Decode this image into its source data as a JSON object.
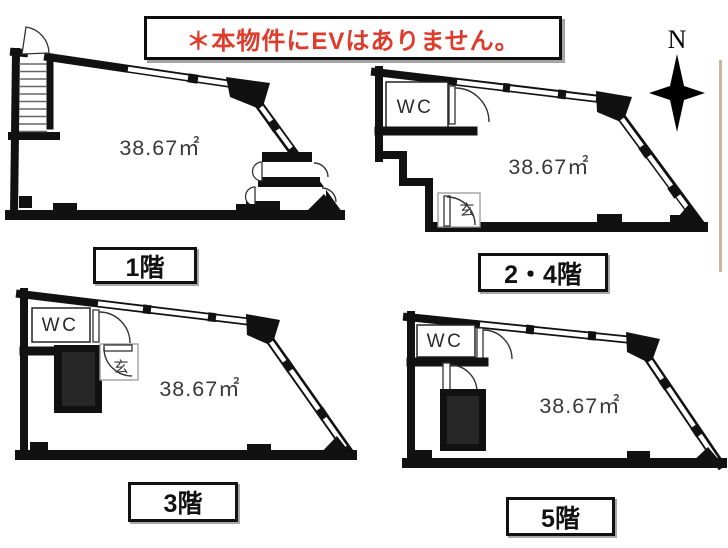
{
  "notice": {
    "text": "＊本物件にEVはありません。",
    "color": "#e03a2b"
  },
  "compass": {
    "label": "N"
  },
  "rooms": {
    "wc": "WC",
    "entrance": "玄"
  },
  "floors": [
    {
      "label": "1階",
      "area": "38.67㎡"
    },
    {
      "label": "2・4階",
      "area": "38.67㎡"
    },
    {
      "label": "3階",
      "area": "38.67㎡"
    },
    {
      "label": "5階",
      "area": "38.67㎡"
    }
  ],
  "colors": {
    "wall": "#111111",
    "shaft_fill": "#272727",
    "notice_red": "#e03a2b",
    "page_edge_tan": "#cbb69a"
  }
}
